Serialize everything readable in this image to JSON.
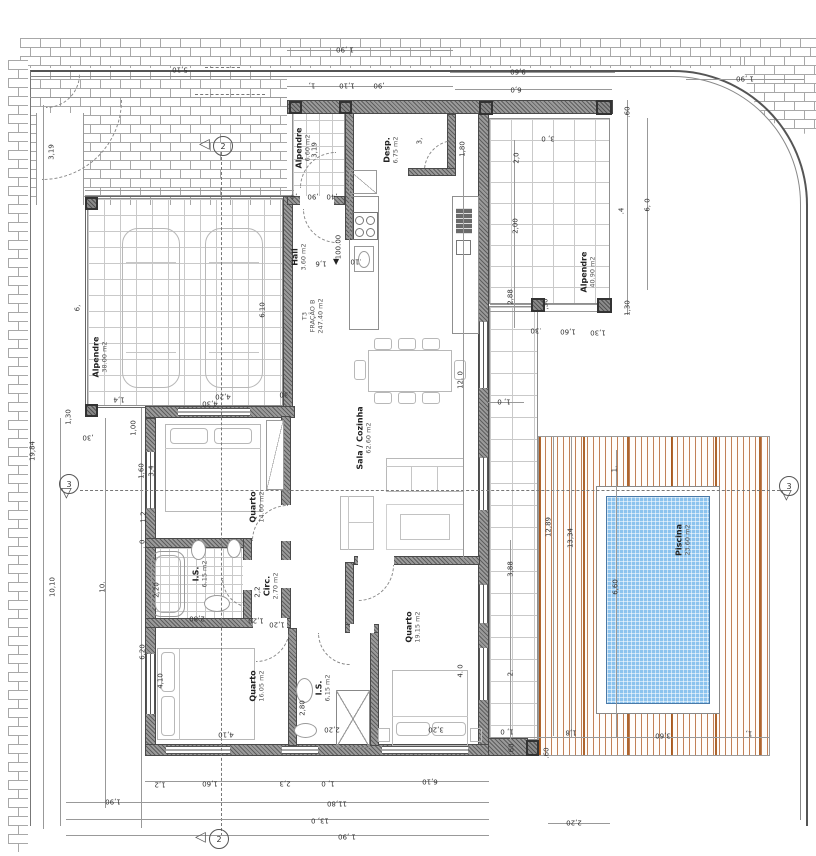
{
  "drawing": {
    "type": "architectural floor plan",
    "unit": {
      "lines": [
        "T3",
        "FRAÇÃO B",
        "247.40 m2"
      ]
    },
    "level_mark": "100.00"
  },
  "colors": {
    "wall": "#9a9a9a",
    "pool_water": "#8cc3ee",
    "deck_stripe": "#c28056",
    "brick_joint": "#a8a8a8",
    "tile_line": "#c9c9c9",
    "text": "#333333"
  },
  "rooms": [
    {
      "lines": [
        "Alpendre",
        "38.00 m2"
      ],
      "x": 100,
      "y": 357,
      "r": -90
    },
    {
      "lines": [
        "Alpendre",
        "6.60 m2"
      ],
      "x": 303,
      "y": 148,
      "r": -90
    },
    {
      "lines": [
        "Hall",
        "3.60 m2"
      ],
      "x": 299,
      "y": 257,
      "r": -90
    },
    {
      "lines": [
        "Desp.",
        "6.75 m2"
      ],
      "x": 391,
      "y": 150,
      "r": -90
    },
    {
      "lines": [
        "Sala / Cozinha",
        "62.60 m2"
      ],
      "x": 364,
      "y": 438,
      "r": -90
    },
    {
      "lines": [
        "Quarto",
        "14.60 m2"
      ],
      "x": 257,
      "y": 507,
      "r": -90
    },
    {
      "lines": [
        "I.S.",
        "6.15 m2"
      ],
      "x": 200,
      "y": 574,
      "r": -90
    },
    {
      "lines": [
        "Circ.",
        "2.70 m2"
      ],
      "x": 271,
      "y": 586,
      "r": -90
    },
    {
      "lines": [
        "Quarto",
        "16.05 m2"
      ],
      "x": 257,
      "y": 686,
      "r": -90
    },
    {
      "lines": [
        "I.S.",
        "6,15 m2"
      ],
      "x": 323,
      "y": 688,
      "r": -90
    },
    {
      "lines": [
        "Quarto",
        "19.15 m2"
      ],
      "x": 413,
      "y": 627,
      "r": -90
    },
    {
      "lines": [
        "Alpendre",
        "40.90 m2"
      ],
      "x": 588,
      "y": 272,
      "r": -90
    },
    {
      "lines": [
        "Piscina",
        "23.60 m2"
      ],
      "x": 683,
      "y": 540,
      "r": -90
    },
    {
      "lines": [
        "T3",
        "FRAÇÃO B",
        "247.40 m2"
      ],
      "x": 313,
      "y": 316,
      "r": -90,
      "cls": "unit"
    }
  ],
  "dimensions": [
    {
      "t": "1 ,90",
      "x": 345,
      "y": 49,
      "r": 180
    },
    {
      "t": "9,60",
      "x": 518,
      "y": 71,
      "r": 180
    },
    {
      "t": "6,0",
      "x": 516,
      "y": 89,
      "r": 180
    },
    {
      "t": "1,",
      "x": 312,
      "y": 85,
      "r": 180
    },
    {
      "t": "1,10",
      "x": 347,
      "y": 85,
      "r": 180
    },
    {
      "t": ",90",
      "x": 379,
      "y": 85,
      "r": 180
    },
    {
      "t": "5,10",
      "x": 180,
      "y": 69,
      "r": 180
    },
    {
      "t": "1 ,90",
      "x": 745,
      "y": 78,
      "r": 180
    },
    {
      "t": "3, 0",
      "x": 548,
      "y": 138,
      "r": 180
    },
    {
      "t": ".60",
      "x": 628,
      "y": 112,
      "r": -90
    },
    {
      "t": "2,0",
      "x": 517,
      "y": 158,
      "r": -90
    },
    {
      "t": "2,00",
      "x": 516,
      "y": 226,
      "r": -90
    },
    {
      "t": "2,88",
      "x": 511,
      "y": 297,
      "r": -90
    },
    {
      "t": "6, 0",
      "x": 648,
      "y": 205,
      "r": -90
    },
    {
      "t": ".4",
      "x": 622,
      "y": 211,
      "r": -90
    },
    {
      "t": "1,30",
      "x": 628,
      "y": 308,
      "r": -90
    },
    {
      "t": ",30",
      "x": 546,
      "y": 304,
      "r": -90
    },
    {
      "t": ".30",
      "x": 536,
      "y": 330,
      "r": 180
    },
    {
      "t": "1,60",
      "x": 568,
      "y": 331,
      "r": 180
    },
    {
      "t": "1,30",
      "x": 598,
      "y": 332,
      "r": 180
    },
    {
      "t": "3,19",
      "x": 315,
      "y": 150,
      "r": -90
    },
    {
      "t": ",4",
      "x": 294,
      "y": 196,
      "r": 180
    },
    {
      "t": ",90",
      "x": 313,
      "y": 196,
      "r": 180
    },
    {
      "t": ",40",
      "x": 332,
      "y": 196,
      "r": 180
    },
    {
      "t": "3,",
      "x": 420,
      "y": 141,
      "r": -90
    },
    {
      "t": "1,80",
      "x": 463,
      "y": 149,
      "r": -90
    },
    {
      "t": "3,19",
      "x": 52,
      "y": 152,
      "r": -90
    },
    {
      "t": "19,84",
      "x": 33,
      "y": 451,
      "r": -90
    },
    {
      "t": "10,10",
      "x": 53,
      "y": 587,
      "r": -90
    },
    {
      "t": "10.",
      "x": 103,
      "y": 587,
      "r": -90
    },
    {
      "t": "6,20",
      "x": 143,
      "y": 652,
      "r": -90
    },
    {
      "t": "1,60",
      "x": 142,
      "y": 471,
      "r": -90
    },
    {
      "t": "3,4",
      "x": 152,
      "y": 471,
      "r": -90
    },
    {
      "t": "1,2",
      "x": 144,
      "y": 517,
      "r": -90
    },
    {
      "t": ". 0",
      "x": 143,
      "y": 544,
      "r": -90
    },
    {
      "t": "1,30",
      "x": 69,
      "y": 417,
      "r": -90
    },
    {
      "t": ",30",
      "x": 88,
      "y": 437,
      "r": 180
    },
    {
      "t": "1,4",
      "x": 119,
      "y": 399,
      "r": 180
    },
    {
      "t": "1,00",
      "x": 134,
      "y": 428,
      "r": -90
    },
    {
      "t": "6,",
      "x": 78,
      "y": 308,
      "r": -90
    },
    {
      "t": "6.10",
      "x": 263,
      "y": 310,
      "r": -90
    },
    {
      "t": "4,20",
      "x": 223,
      "y": 396,
      "r": 180
    },
    {
      "t": ",30",
      "x": 285,
      "y": 394,
      "r": 180
    },
    {
      "t": "4,30",
      "x": 210,
      "y": 403,
      "r": 180
    },
    {
      "t": "2,20",
      "x": 157,
      "y": 590,
      "r": -90
    },
    {
      "t": "4,10",
      "x": 161,
      "y": 681,
      "r": -90
    },
    {
      "t": "2,80",
      "x": 197,
      "y": 618,
      "r": 180
    },
    {
      "t": "1,20",
      "x": 256,
      "y": 620,
      "r": 180
    },
    {
      "t": "1,20",
      "x": 277,
      "y": 624,
      "r": 180
    },
    {
      "t": "2,2",
      "x": 258,
      "y": 592,
      "r": -90
    },
    {
      "t": "1,6",
      "x": 321,
      "y": 263,
      "r": 180
    },
    {
      "t": ".10",
      "x": 356,
      "y": 261,
      "r": 180
    },
    {
      "t": "100.00",
      "x": 339,
      "y": 247,
      "r": -90
    },
    {
      "t": "3,20",
      "x": 436,
      "y": 729,
      "r": 180
    },
    {
      "t": "4,10",
      "x": 226,
      "y": 734,
      "r": 180
    },
    {
      "t": "2,20",
      "x": 332,
      "y": 729,
      "r": 180
    },
    {
      "t": "2,80",
      "x": 303,
      "y": 708,
      "r": -90
    },
    {
      "t": "12. 0",
      "x": 461,
      "y": 380,
      "r": -90
    },
    {
      "t": "4. 0",
      "x": 461,
      "y": 671,
      "r": -90
    },
    {
      "t": "1, 0",
      "x": 504,
      "y": 401,
      "r": 180
    },
    {
      "t": "3,88",
      "x": 511,
      "y": 569,
      "r": -90
    },
    {
      "t": "2.",
      "x": 511,
      "y": 673,
      "r": -90
    },
    {
      "t": "12,89",
      "x": 549,
      "y": 527,
      "r": -90
    },
    {
      "t": "13,34",
      "x": 571,
      "y": 538,
      "r": -90
    },
    {
      "t": "6,60",
      "x": 616,
      "y": 587,
      "r": -90
    },
    {
      "t": "1.",
      "x": 615,
      "y": 469,
      "r": -90
    },
    {
      "t": "1, 0",
      "x": 507,
      "y": 731,
      "r": 180
    },
    {
      "t": "1,8",
      "x": 571,
      "y": 732,
      "r": 180
    },
    {
      "t": "3,60",
      "x": 663,
      "y": 735,
      "r": 180
    },
    {
      "t": "1,",
      "x": 749,
      "y": 733,
      "r": 180
    },
    {
      "t": ".60",
      "x": 512,
      "y": 749,
      "r": -90
    },
    {
      "t": ".60",
      "x": 547,
      "y": 753,
      "r": -90
    },
    {
      "t": "1,2",
      "x": 160,
      "y": 784,
      "r": 180
    },
    {
      "t": "1,60",
      "x": 210,
      "y": 783,
      "r": 180
    },
    {
      "t": "2,3",
      "x": 285,
      "y": 783,
      "r": 180
    },
    {
      "t": "1, 0",
      "x": 328,
      "y": 783,
      "r": 180
    },
    {
      "t": "6,10",
      "x": 430,
      "y": 781,
      "r": 180
    },
    {
      "t": "1,90",
      "x": 113,
      "y": 801,
      "r": 180
    },
    {
      "t": "11,80",
      "x": 337,
      "y": 803,
      "r": 180
    },
    {
      "t": "13, 0",
      "x": 320,
      "y": 820,
      "r": 180
    },
    {
      "t": "1 ,90",
      "x": 347,
      "y": 836,
      "r": 180
    },
    {
      "t": "2,20",
      "x": 574,
      "y": 822,
      "r": 180
    }
  ],
  "markers": [
    {
      "label": "2",
      "x": 222,
      "y": 145,
      "dir": "left"
    },
    {
      "label": "3",
      "x": 68,
      "y": 490,
      "dir": "down"
    },
    {
      "label": "3",
      "x": 788,
      "y": 492,
      "dir": "down"
    },
    {
      "label": "2",
      "x": 218,
      "y": 838,
      "dir": "left"
    }
  ]
}
